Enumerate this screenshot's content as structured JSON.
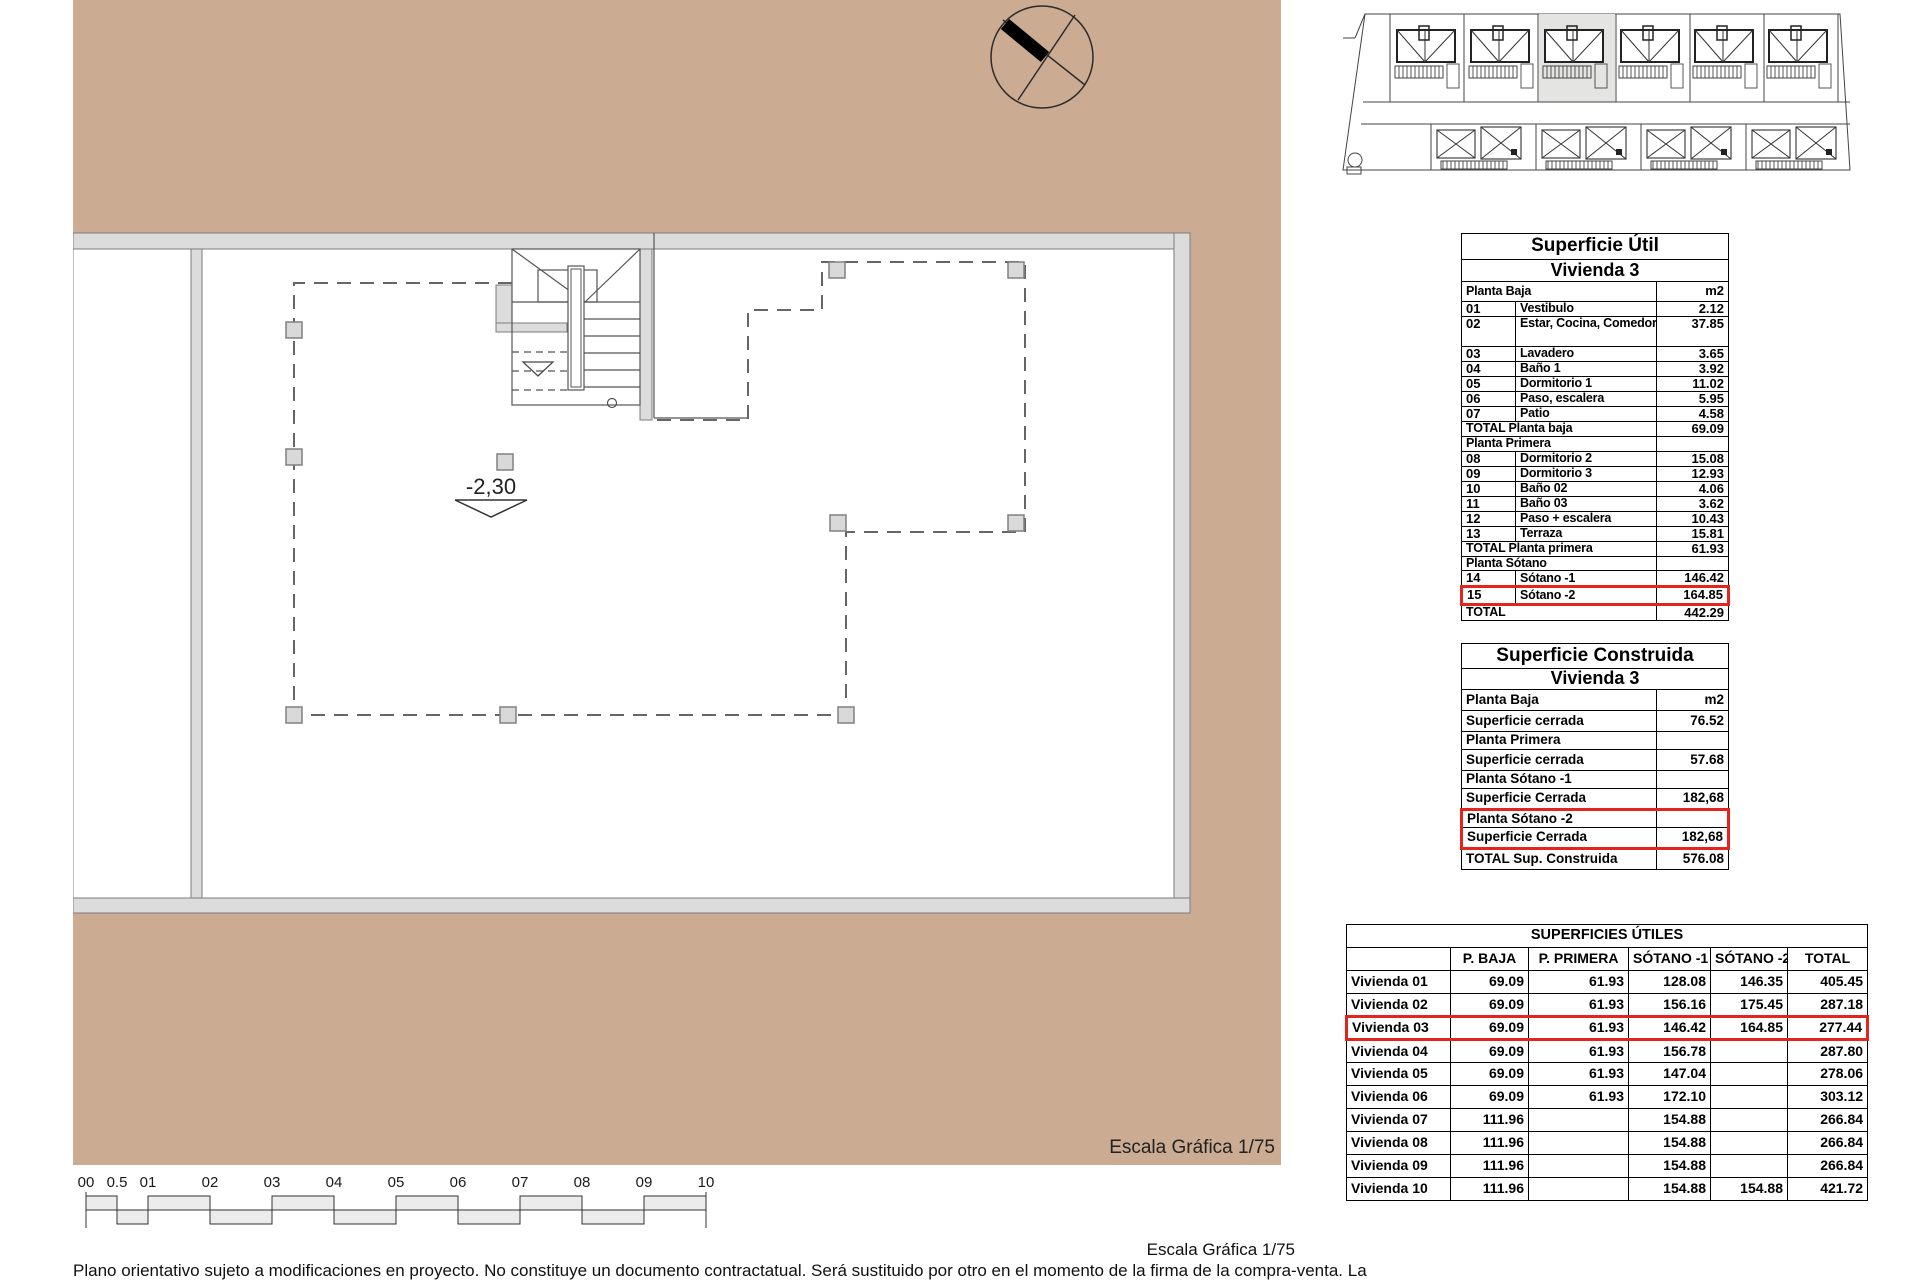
{
  "colors": {
    "terrain_tan": "#cbab92",
    "highlight_red": "#e4251b",
    "wall_gray": "#dcdcdc"
  },
  "plan": {
    "level_label": "-2,30",
    "scale_label": "Escala Gráfica 1/75"
  },
  "scale_bar": {
    "labels": [
      "00",
      "0.5",
      "01",
      "02",
      "03",
      "04",
      "05",
      "06",
      "07",
      "08",
      "09",
      "10"
    ]
  },
  "footer": {
    "scale_label": "Escala Gráfica 1/75",
    "disclaimer": "Plano orientativo sujeto a modificaciones en proyecto. No constituye un documento contractatual. Será sustituido por otro en el momento de la firma de la compra-venta. La"
  },
  "tables": {
    "util": {
      "title": "Superficie Útil",
      "subtitle": "Vivienda 3",
      "rows": [
        {
          "t": "unit",
          "label": "Planta Baja",
          "val": "m2"
        },
        {
          "t": "d3",
          "num": "01",
          "label": "Vestibulo",
          "val": "2.12"
        },
        {
          "t": "d3",
          "num": "02",
          "label": "Estar, Cocina, Comedor",
          "val": "37.85",
          "tall": true
        },
        {
          "t": "d3",
          "num": "03",
          "label": "Lavadero",
          "val": "3.65"
        },
        {
          "t": "d3",
          "num": "04",
          "label": "Baño 1",
          "val": "3.92"
        },
        {
          "t": "d3",
          "num": "05",
          "label": "Dormitorio 1",
          "val": "11.02"
        },
        {
          "t": "d3",
          "num": "06",
          "label": "Paso, escalera",
          "val": "5.95"
        },
        {
          "t": "d3",
          "num": "07",
          "label": "Patio",
          "val": "4.58"
        },
        {
          "t": "tot",
          "label": "TOTAL Planta baja",
          "val": "69.09"
        },
        {
          "t": "sec",
          "label": "Planta Primera"
        },
        {
          "t": "d3",
          "num": "08",
          "label": "Dormitorio 2",
          "val": "15.08"
        },
        {
          "t": "d3",
          "num": "09",
          "label": "Dormitorio 3",
          "val": "12.93"
        },
        {
          "t": "d3",
          "num": "10",
          "label": "Baño 02",
          "val": "4.06"
        },
        {
          "t": "d3",
          "num": "11",
          "label": "Baño 03",
          "val": "3.62"
        },
        {
          "t": "d3",
          "num": "12",
          "label": "Paso + escalera",
          "val": "10.43"
        },
        {
          "t": "d3",
          "num": "13",
          "label": "Terraza",
          "val": "15.81"
        },
        {
          "t": "tot",
          "label": "TOTAL Planta primera",
          "val": "61.93"
        },
        {
          "t": "sec",
          "label": "Planta Sótano"
        },
        {
          "t": "d3",
          "num": "14",
          "label": "Sótano -1",
          "val": "146.42"
        },
        {
          "t": "d3",
          "num": "15",
          "label": "Sótano -2",
          "val": "164.85",
          "hl": "row"
        },
        {
          "t": "tot",
          "label": "TOTAL",
          "val": "442.29"
        }
      ]
    },
    "construida": {
      "title": "Superficie Construida",
      "subtitle": "Vivienda 3",
      "rows": [
        {
          "t": "unit",
          "label": "Planta Baja",
          "val": "m2"
        },
        {
          "t": "d2",
          "label": "Superficie cerrada",
          "val": "76.52"
        },
        {
          "t": "sec",
          "label": "Planta Primera"
        },
        {
          "t": "d2",
          "label": "Superficie cerrada",
          "val": "57.68"
        },
        {
          "t": "sec",
          "label": "Planta Sótano -1"
        },
        {
          "t": "d2",
          "label": "Superficie Cerrada",
          "val": "182,68"
        },
        {
          "t": "sec",
          "label": "Planta Sótano -2",
          "hl": "top"
        },
        {
          "t": "d2",
          "label": "Superficie Cerrada",
          "val": "182,68",
          "hl": "bot"
        },
        {
          "t": "tot",
          "label": "TOTAL Sup. Construida",
          "val": "576.08"
        }
      ]
    },
    "resumen": {
      "title": "SUPERFICIES ÚTILES",
      "columns": [
        "",
        "P. BAJA",
        "P. PRIMERA",
        "SÓTANO -1",
        "SÓTANO -2",
        "TOTAL"
      ],
      "rows": [
        {
          "label": "Vivienda 01",
          "vals": [
            "69.09",
            "61.93",
            "128.08",
            "146.35",
            "405.45"
          ]
        },
        {
          "label": "Vivienda 02",
          "vals": [
            "69.09",
            "61.93",
            "156.16",
            "175.45",
            "287.18"
          ]
        },
        {
          "label": "Vivienda 03",
          "vals": [
            "69.09",
            "61.93",
            "146.42",
            "164.85",
            "277.44"
          ],
          "hl": "row"
        },
        {
          "label": "Vivienda 04",
          "vals": [
            "69.09",
            "61.93",
            "156.78",
            "",
            "287.80"
          ]
        },
        {
          "label": "Vivienda 05",
          "vals": [
            "69.09",
            "61.93",
            "147.04",
            "",
            "278.06"
          ]
        },
        {
          "label": "Vivienda 06",
          "vals": [
            "69.09",
            "61.93",
            "172.10",
            "",
            "303.12"
          ]
        },
        {
          "label": "Vivienda 07",
          "vals": [
            "111.96",
            "",
            "154.88",
            "",
            "266.84"
          ]
        },
        {
          "label": "Vivienda 08",
          "vals": [
            "111.96",
            "",
            "154.88",
            "",
            "266.84"
          ]
        },
        {
          "label": "Vivienda 09",
          "vals": [
            "111.96",
            "",
            "154.88",
            "",
            "266.84"
          ]
        },
        {
          "label": "Vivienda 10",
          "vals": [
            "111.96",
            "",
            "154.88",
            "154.88",
            "421.72"
          ]
        }
      ]
    }
  }
}
